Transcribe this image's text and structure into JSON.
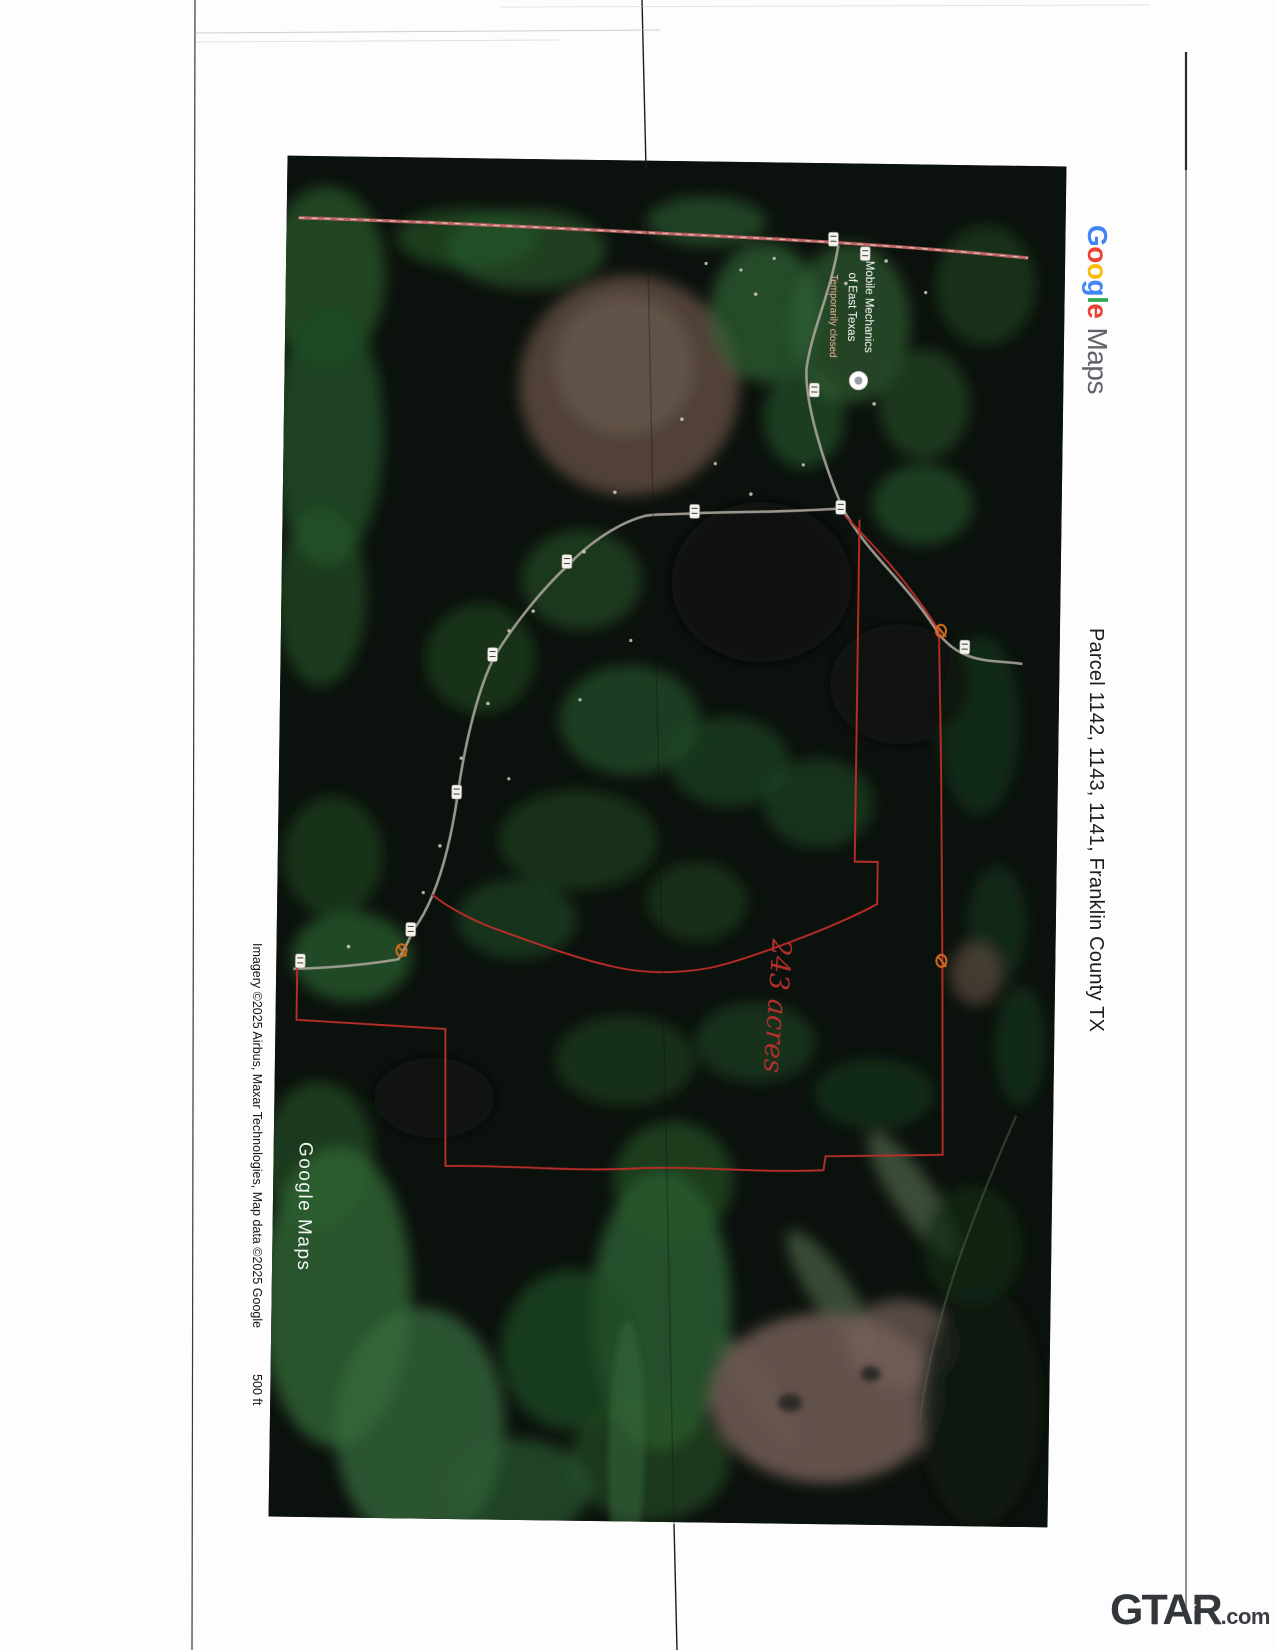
{
  "google_logo": {
    "letters": [
      "G",
      "o",
      "o",
      "g",
      "l",
      "e"
    ],
    "maps": "Maps",
    "colors": {
      "blue": "#4285F4",
      "red": "#EA4335",
      "yellow": "#FBBC05",
      "green": "#34A853",
      "gray": "#5F6368"
    }
  },
  "side_caption": {
    "text": "Parcel 1142, 1143, 1141, Franklin County TX"
  },
  "attribution": {
    "imagery": "Imagery ©2025 Airbus, Maxar Technologies, Map data ©2025 Google",
    "scale": "500 ft"
  },
  "map": {
    "watermark": "Google Maps",
    "poi": {
      "line1": "Mobile Mechanics",
      "line2": "of East Texas",
      "status": "Temporarily closed"
    },
    "annotation": "243 acres",
    "colors": {
      "boundary_red": "#B92D28",
      "marker_orange": "#D2691E",
      "road_gray": "#A8A49A",
      "highway_pink": "#C06565",
      "base_dark": "#0B110C",
      "poi_status": "#F2B3A0"
    }
  },
  "footer": {
    "brand": "GTAR",
    "suffix": ".com"
  }
}
